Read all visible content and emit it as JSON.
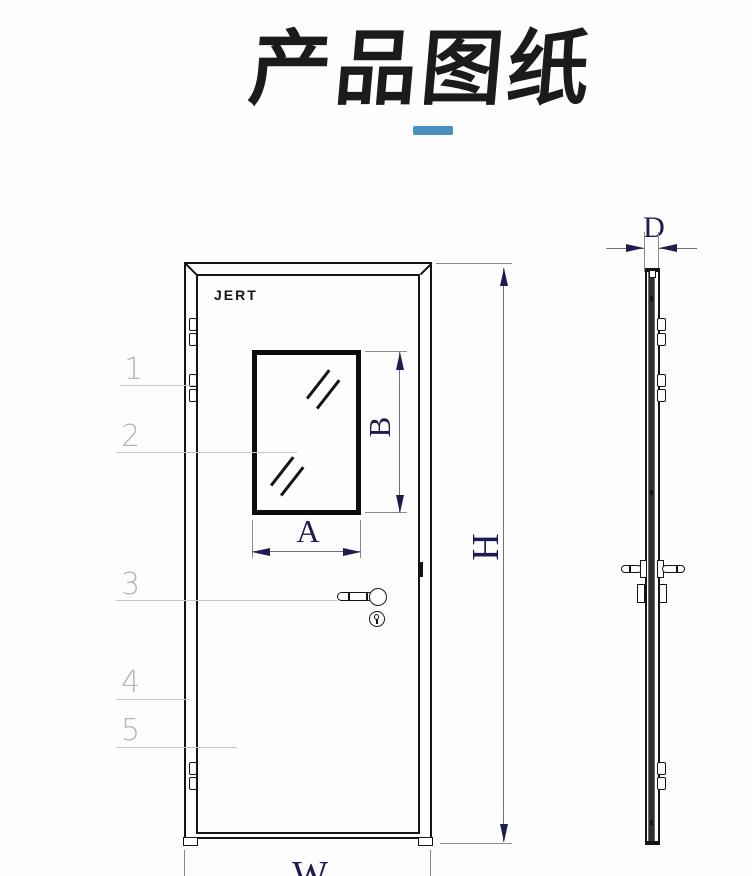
{
  "header": {
    "title": "产品图纸",
    "underline_color": "#4a8fc2"
  },
  "front_view": {
    "brand": "JERT",
    "callouts": [
      "1",
      "2",
      "3",
      "4",
      "5"
    ],
    "dims": {
      "window_width": "A",
      "window_height": "B",
      "door_height": "H",
      "door_width": "W"
    }
  },
  "side_view": {
    "dims": {
      "thickness": "D"
    }
  },
  "colors": {
    "line_black": "#141414",
    "dimension_navy": "#1c1c50",
    "accent_blue": "#4a8fc2",
    "callout_gray": "#b4b4b4"
  }
}
